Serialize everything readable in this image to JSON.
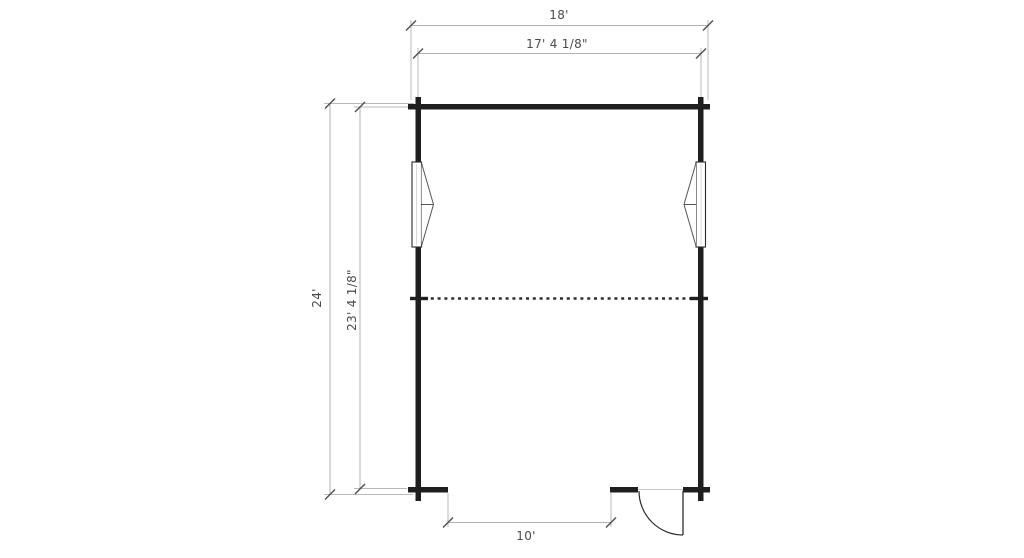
{
  "floor_plan": {
    "title": "Floor plan drawing",
    "dims": {
      "width_overall": "18'",
      "width_interior": "17' 4 1/8\"",
      "height_overall": "24'",
      "height_interior": "23' 4 1/8\"",
      "front_opening": "10'"
    },
    "features": {
      "left_window": "window-symbol",
      "right_window": "window-symbol",
      "loft_edge": "dashed-line",
      "entry_door": "door-swing-symbol",
      "front_opening": "wall-opening"
    },
    "colors": {
      "wall": "#1f1f1f",
      "dimension_line": "#b0b0b0",
      "tick": "#4f4f4f",
      "label": "#4a4a4a",
      "background": "#ffffff"
    }
  }
}
